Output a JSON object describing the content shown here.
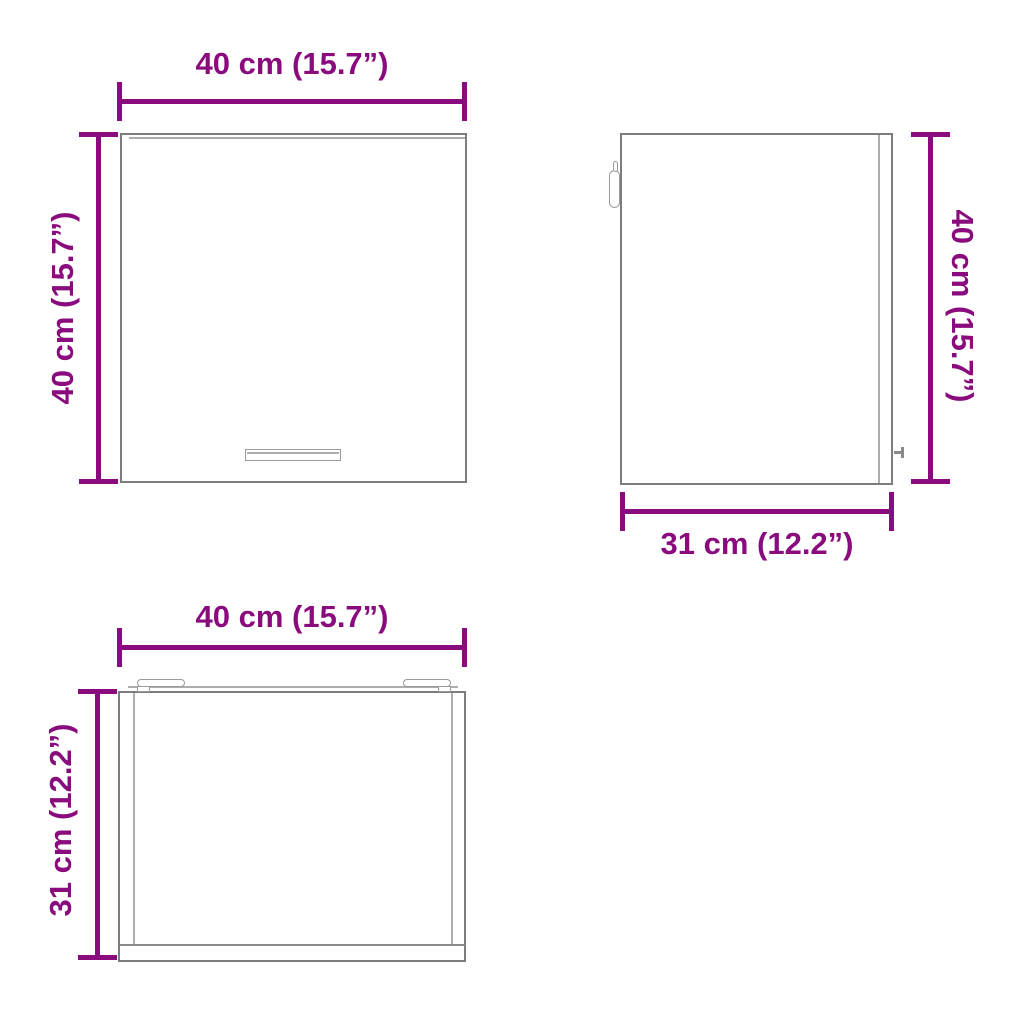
{
  "diagram": {
    "colors": {
      "dimension_color": "#8A0B7D",
      "outline_color": "#7D7D7D",
      "background_color": "#FFFFFF"
    },
    "views": {
      "front": {
        "width_label": "40 cm (15.7”)",
        "height_label": "40 cm (15.7”)"
      },
      "side": {
        "height_label": "40 cm (15.7”)",
        "depth_label": "31 cm (12.2”)"
      },
      "top": {
        "width_label": "40 cm (15.7”)",
        "depth_label": "31 cm (12.2”)"
      }
    }
  }
}
